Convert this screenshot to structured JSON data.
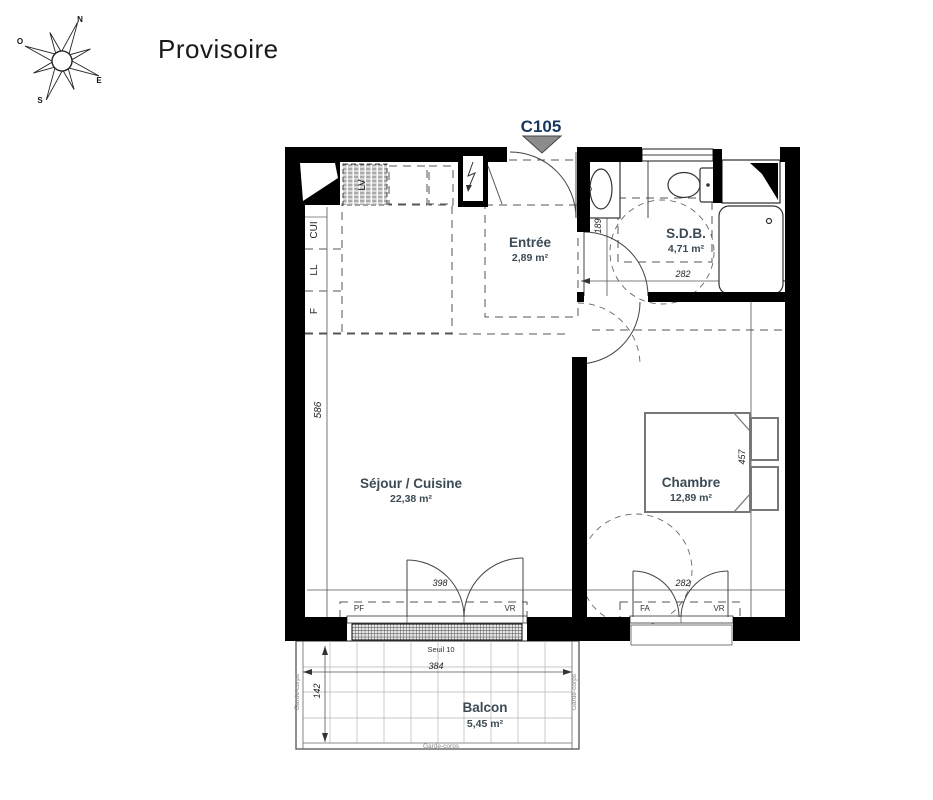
{
  "page": {
    "title": "Provisoire",
    "unit": "C105"
  },
  "compass": {
    "north": "N",
    "south": "S",
    "east": "E",
    "west": "O"
  },
  "rooms": {
    "entree": {
      "name": "Entrée",
      "area": "2,89 m²"
    },
    "sdb": {
      "name": "S.D.B.",
      "area": "4,71 m²"
    },
    "sejour": {
      "name": "Séjour / Cuisine",
      "area": "22,38 m²"
    },
    "chambre": {
      "name": "Chambre",
      "area": "12,89 m²"
    },
    "balcon": {
      "name": "Balcon",
      "area": "5,45 m²"
    }
  },
  "dimensions": {
    "sejour_height": "586",
    "entree_width": "189",
    "sdb_width": "282",
    "chambre_height": "457",
    "sejour_window_width": "398",
    "chambre_window_width": "282",
    "balcon_width": "384",
    "balcon_depth": "142",
    "threshold": "Seuil 10"
  },
  "fixtures": {
    "kitchen_unit": "CUI",
    "washing_machine": "LL",
    "fridge": "F",
    "dishwasher": "LV"
  },
  "openings": {
    "french_door": "PF",
    "roller_shutter": "VR",
    "window": "FA"
  },
  "balcony": {
    "railing": "Garde-corps"
  },
  "colors": {
    "unit_label": "#17375E",
    "room_label": "#3B4A54",
    "wall": "#000000",
    "entrance_arrow": "#8C8C8C"
  }
}
